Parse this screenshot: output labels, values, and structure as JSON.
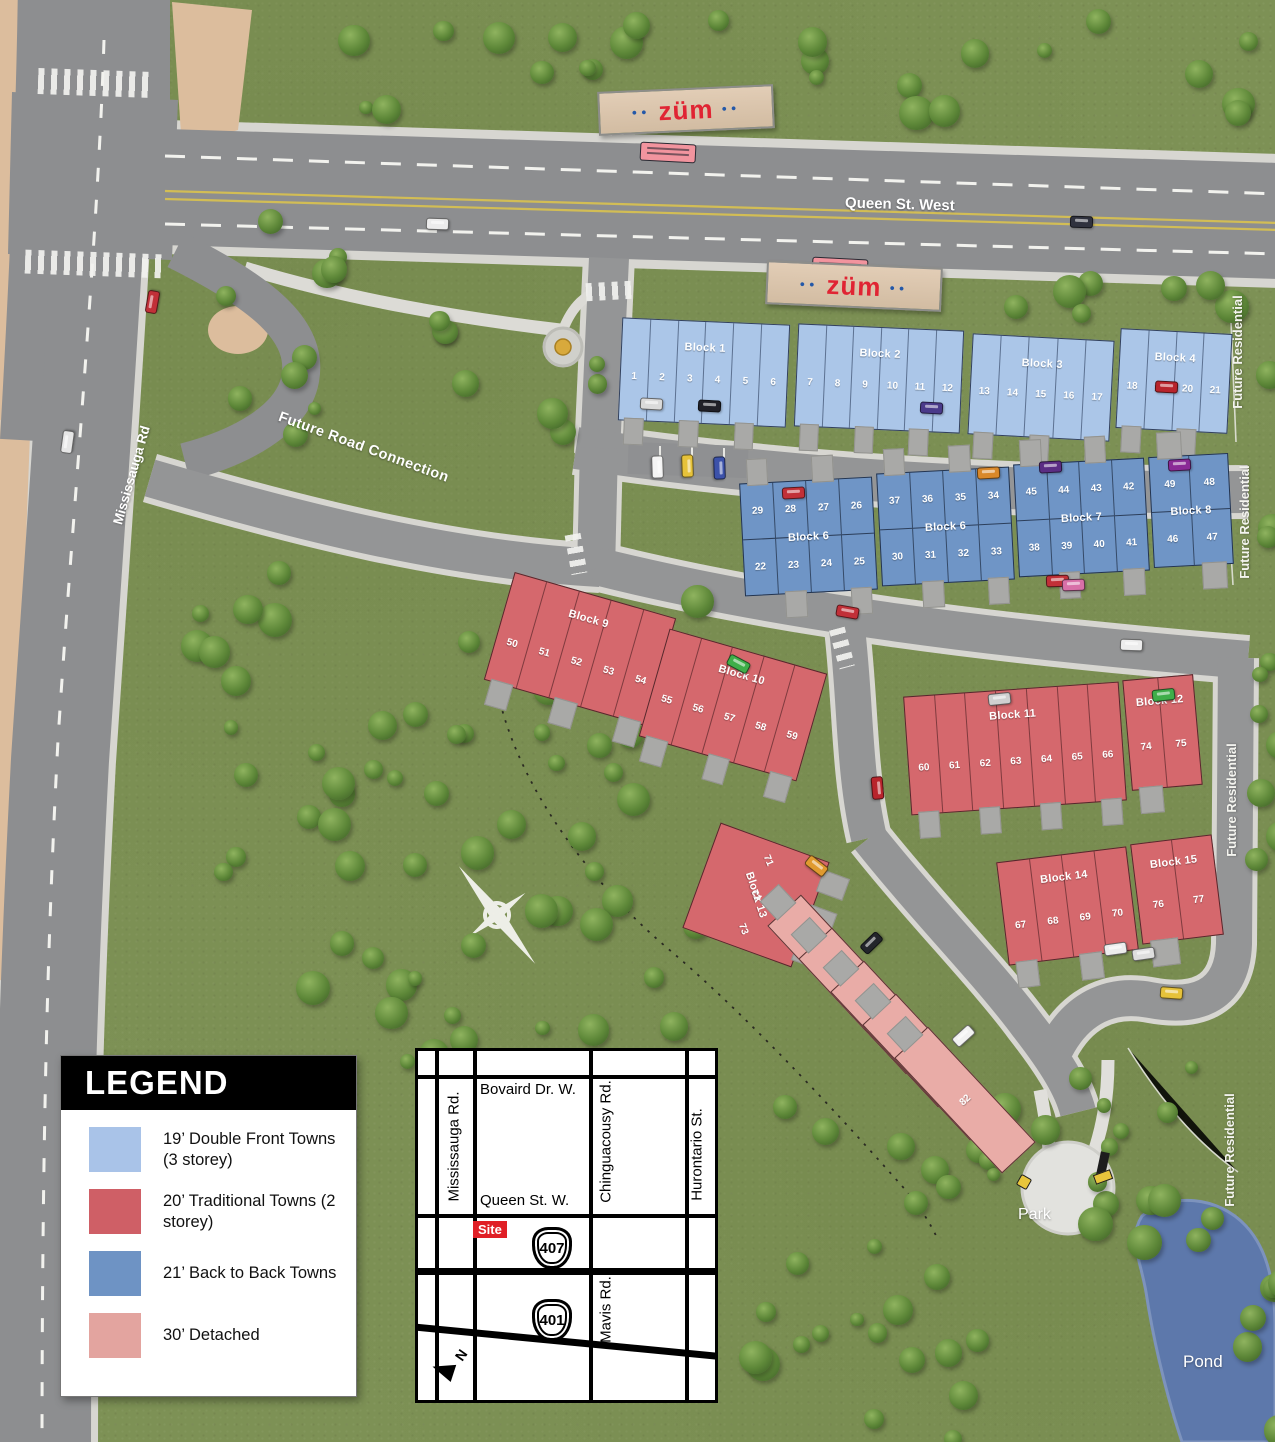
{
  "map_labels": {
    "queen_st": "Queen St. West",
    "mississauga_rd": "Mississauga Rd",
    "future_road": "Future Road Connection",
    "future_residential": "Future Residential",
    "park": "Park",
    "pond": "Pond",
    "compass_n": "N",
    "zum": "züm"
  },
  "legend": {
    "title": "LEGEND",
    "items": [
      {
        "label": "19’ Double Front Towns (3 storey)",
        "color": "#a9c3e8"
      },
      {
        "label": "20’ Traditional Towns (2 storey)",
        "color": "#cf5f66"
      },
      {
        "label": "21’ Back to Back Towns",
        "color": "#6e93c4"
      },
      {
        "label": "30’ Detached",
        "color": "#e3a49f"
      }
    ]
  },
  "block_types": {
    "double_front": "#abc6e8",
    "back_to_back": "#6f95c6",
    "traditional": "#d5686d",
    "detached": "#e9aca7"
  },
  "blocks": [
    {
      "name": "Block 1",
      "type": "double_front",
      "rows": [
        [
          "1",
          "2",
          "3",
          "4",
          "5",
          "6"
        ]
      ]
    },
    {
      "name": "Block 2",
      "type": "double_front",
      "rows": [
        [
          "7",
          "8",
          "9",
          "10",
          "11",
          "12"
        ]
      ]
    },
    {
      "name": "Block 3",
      "type": "double_front",
      "rows": [
        [
          "13",
          "14",
          "15",
          "16",
          "17"
        ]
      ]
    },
    {
      "name": "Block 4",
      "type": "double_front",
      "rows": [
        [
          "18",
          "19",
          "20",
          "21"
        ]
      ]
    },
    {
      "name": "Block 6",
      "type": "back_to_back",
      "rows": [
        [
          "29",
          "28",
          "27",
          "26"
        ],
        [
          "22",
          "23",
          "24",
          "25"
        ]
      ]
    },
    {
      "name": "Block 6",
      "type": "back_to_back",
      "rows": [
        [
          "37",
          "36",
          "35",
          "34"
        ],
        [
          "30",
          "31",
          "32",
          "33"
        ]
      ]
    },
    {
      "name": "Block 7",
      "type": "back_to_back",
      "rows": [
        [
          "45",
          "44",
          "43",
          "42"
        ],
        [
          "38",
          "39",
          "40",
          "41"
        ]
      ]
    },
    {
      "name": "Block 8",
      "type": "back_to_back",
      "rows": [
        [
          "49",
          "48"
        ],
        [
          "46",
          "47"
        ]
      ]
    },
    {
      "name": "Block 9",
      "type": "traditional",
      "rows": [
        [
          "50",
          "51",
          "52",
          "53",
          "54"
        ]
      ]
    },
    {
      "name": "Block 10",
      "type": "traditional",
      "rows": [
        [
          "55",
          "56",
          "57",
          "58",
          "59"
        ]
      ]
    },
    {
      "name": "Block 11",
      "type": "traditional",
      "rows": [
        [
          "60",
          "61",
          "62",
          "63",
          "64",
          "65",
          "66"
        ]
      ]
    },
    {
      "name": "Block 12",
      "type": "traditional",
      "rows": [
        [
          "74",
          "75"
        ]
      ]
    },
    {
      "name": "Block 13",
      "type": "traditional",
      "rows": [
        [
          "71",
          "72",
          "73"
        ]
      ]
    },
    {
      "name": "Block 14",
      "type": "traditional",
      "rows": [
        [
          "67",
          "68",
          "69",
          "70"
        ]
      ]
    },
    {
      "name": "Block 15",
      "type": "traditional",
      "rows": [
        [
          "76",
          "77"
        ]
      ]
    },
    {
      "name": "",
      "type": "detached",
      "rows": [
        [
          "78",
          "79",
          "80",
          "81",
          "82"
        ]
      ]
    }
  ],
  "inset_map": {
    "roads_vertical": [
      "Mississauga Rd.",
      "Chinguacousy Rd.",
      "Mavis Rd.",
      "Hurontario St."
    ],
    "roads_horizontal": [
      "Bovaird Dr. W.",
      "Queen St. W."
    ],
    "site_label": "Site",
    "highways": [
      "407",
      "401"
    ],
    "north": "N"
  }
}
